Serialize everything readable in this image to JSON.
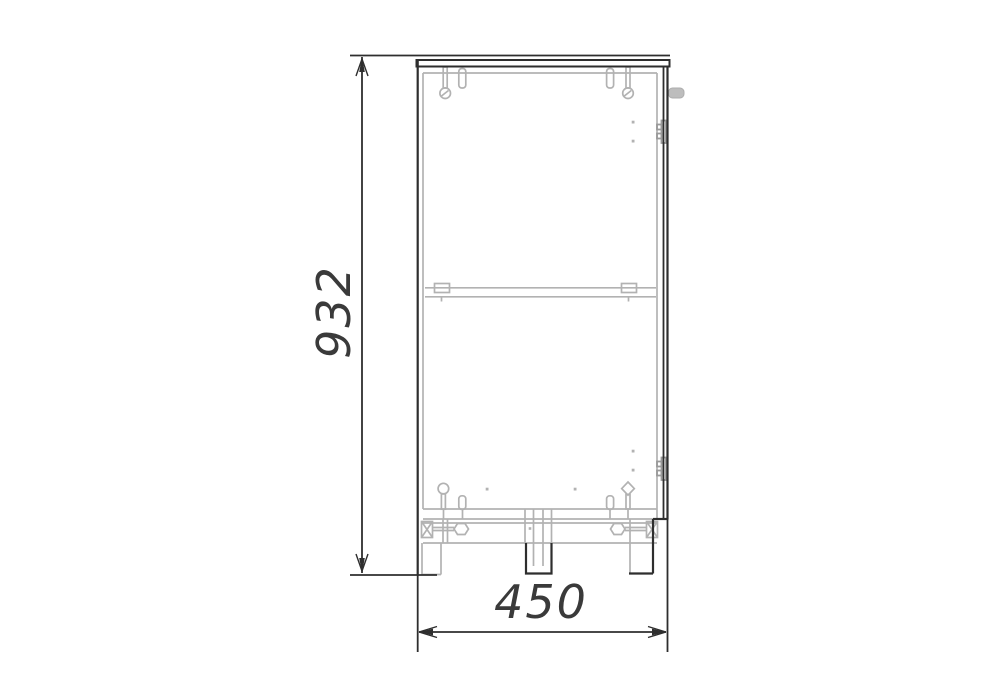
{
  "drawing": {
    "height_dimension": {
      "value": "932"
    },
    "width_dimension": {
      "value": "450"
    },
    "colors": {
      "background": "#ffffff",
      "outline": "#2e2e2e",
      "hardware_gray": "#b2b2b2",
      "hinge_gray": "#9a9a9a",
      "handle_fill": "#bdbdbd",
      "dimension_text": "#3a3a3a"
    },
    "parts": [
      "top-panel",
      "back-panel",
      "door",
      "door-handle",
      "hinge-top",
      "hinge-bottom",
      "shelf",
      "shelf-clips",
      "bottom-panel",
      "plinth-rail",
      "corner-brackets",
      "bolts",
      "screws",
      "dowels",
      "left-leg",
      "center-leg",
      "right-leg"
    ]
  }
}
